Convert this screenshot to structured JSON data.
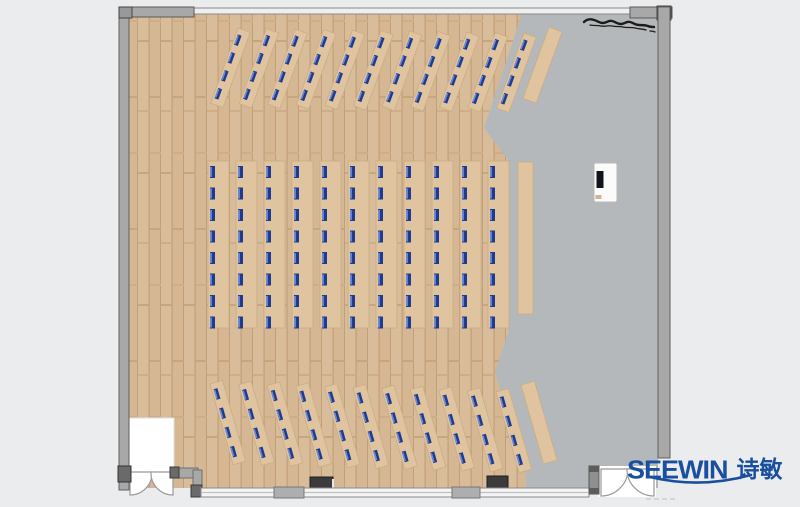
{
  "brand": {
    "wordmark": "SEEWIN",
    "cjk": "诗敏",
    "color": "#1a4fa0"
  },
  "colors": {
    "outside": "#ebeced",
    "wall": "#a8a8a8",
    "wall-edge": "#5f5f5f",
    "wall-dark": "#6a6a6a",
    "floor-gray": "#b5b8ba",
    "floor-wood": "#d5b794",
    "plank-line": "#c19f78",
    "desk": "#e0c49f",
    "desk-edge": "#c9ad85",
    "seat": "#1e3c8f",
    "seat-hi": "#6e88d4",
    "column-dark": "#3b3b3b",
    "podium": "#fbfbfb",
    "brand-blue": "#1a4fa0"
  },
  "floorplan": {
    "seat_total": 176,
    "groups": [
      {
        "name": "front-angled-rows",
        "rotation_deg": 20,
        "strip_count": 11,
        "origin": {
          "x": 238,
          "y": 28
        },
        "x_pitch": 28.6,
        "y_step": 0.5,
        "strip": {
          "w": 13,
          "len": 80
        },
        "seats_per_strip": 4,
        "seat_offset": 6,
        "seat_pitch": 19,
        "seat": {
          "w": 4,
          "h": 11
        },
        "counter": {
          "x": 549,
          "y": 27,
          "w": 14,
          "len": 76
        }
      },
      {
        "name": "center-straight-rows",
        "rotation_deg": 0,
        "strip_count": 11,
        "origin": {
          "x": 208,
          "y": 161
        },
        "x_pitch": 28,
        "y_step": 0,
        "strip": {
          "w": 21,
          "len": 167
        },
        "seats_per_strip": 8,
        "seat_offset": 5,
        "seat_pitch": 21.5,
        "seat": {
          "w": 5,
          "h": 12
        },
        "counter": {
          "x": 518,
          "y": 162,
          "w": 15,
          "len": 152
        }
      },
      {
        "name": "rear-angled-rows",
        "rotation_deg": -16,
        "strip_count": 11,
        "origin": {
          "x": 210,
          "y": 384
        },
        "x_pitch": 28.6,
        "y_step": 0.8,
        "strip": {
          "w": 13,
          "len": 84
        },
        "seats_per_strip": 4,
        "seat_offset": 6,
        "seat_pitch": 20,
        "seat": {
          "w": 4,
          "h": 11
        },
        "counter": {
          "x": 521,
          "y": 385,
          "w": 14,
          "len": 82
        }
      }
    ],
    "podium": {
      "x": 594,
      "y": 163,
      "w": 23,
      "h": 39
    },
    "objects": [
      {
        "name": "marker-scribble",
        "note": "hand-drawn squiggle near top-right wall"
      },
      {
        "name": "structural-column",
        "positions": [
          [
            310,
            477
          ],
          [
            487,
            476
          ]
        ]
      },
      {
        "name": "double-door-left",
        "position": [
          129,
          472
        ]
      },
      {
        "name": "double-door-right",
        "position": [
          600,
          469
        ]
      },
      {
        "name": "door-recess",
        "rect": [
          129,
          418,
          45,
          54
        ]
      },
      {
        "name": "window-wall-bottom",
        "span": [
          199,
          589
        ]
      }
    ]
  }
}
